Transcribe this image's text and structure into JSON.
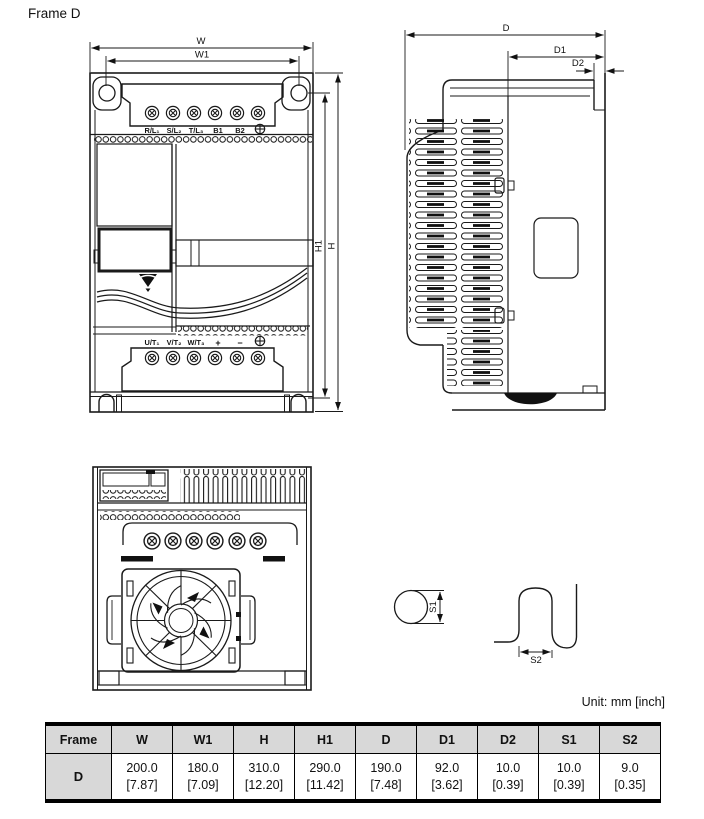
{
  "page": {
    "title": "Frame D",
    "unit_label": "Unit: mm [inch]"
  },
  "colors": {
    "line": "#1a1a1a",
    "table_header_bg": "#d8d8d8",
    "background": "#ffffff"
  },
  "front_view": {
    "dims": {
      "w": "W",
      "w1": "W1",
      "h": "H",
      "h1": "H1"
    },
    "input_terminals": [
      "R/L₁",
      "S/L₂",
      "T/L₃",
      "B1",
      "B2"
    ],
    "output_terminals": [
      "U/T₁",
      "V/T₂",
      "W/T₃",
      "+",
      "−"
    ]
  },
  "side_view": {
    "dims": {
      "d": "D",
      "d1": "D1",
      "d2": "D2"
    }
  },
  "details": {
    "s1_label": "S1",
    "s2_label": "S2"
  },
  "table": {
    "headers": [
      "Frame",
      "W",
      "W1",
      "H",
      "H1",
      "D",
      "D1",
      "D2",
      "S1",
      "S2"
    ],
    "rows": [
      {
        "frame": "D",
        "values_mm": [
          "200.0",
          "180.0",
          "310.0",
          "290.0",
          "190.0",
          "92.0",
          "10.0",
          "10.0",
          "9.0"
        ],
        "values_inch": [
          "[7.87]",
          "[7.09]",
          "[12.20]",
          "[11.42]",
          "[7.48]",
          "[3.62]",
          "[0.39]",
          "[0.39]",
          "[0.35]"
        ]
      }
    ]
  }
}
